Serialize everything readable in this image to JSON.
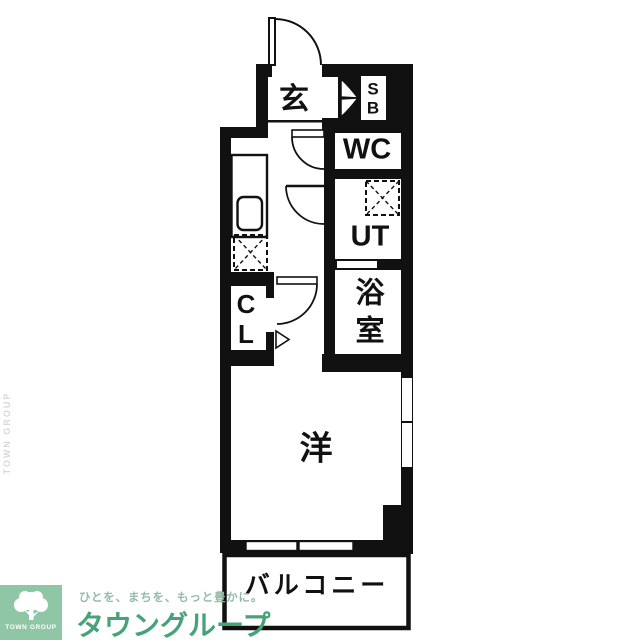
{
  "plan": {
    "rooms": {
      "entrance": {
        "label": "玄"
      },
      "shoe_box": {
        "line1": "S",
        "line2": "B"
      },
      "wc": {
        "label": "WC"
      },
      "utility": {
        "label": "UT"
      },
      "bathroom": {
        "line1": "浴",
        "line2": "室"
      },
      "closet": {
        "line1": "C",
        "line2": "L"
      },
      "western_room": {
        "label": "洋"
      },
      "balcony": {
        "label": "バルコニー"
      }
    },
    "colors": {
      "wall": "#111111",
      "floor": "#ffffff"
    }
  },
  "logo": {
    "square_text": "TOWN GROUP",
    "tagline": "ひとを、まちを、もっと豊かに。",
    "brand": "タウングループ",
    "vertical_text": "TOWN GROUP",
    "colors": {
      "square": "#8fc6a5",
      "brand": "#47a377",
      "tagline": "#93bba7"
    }
  }
}
